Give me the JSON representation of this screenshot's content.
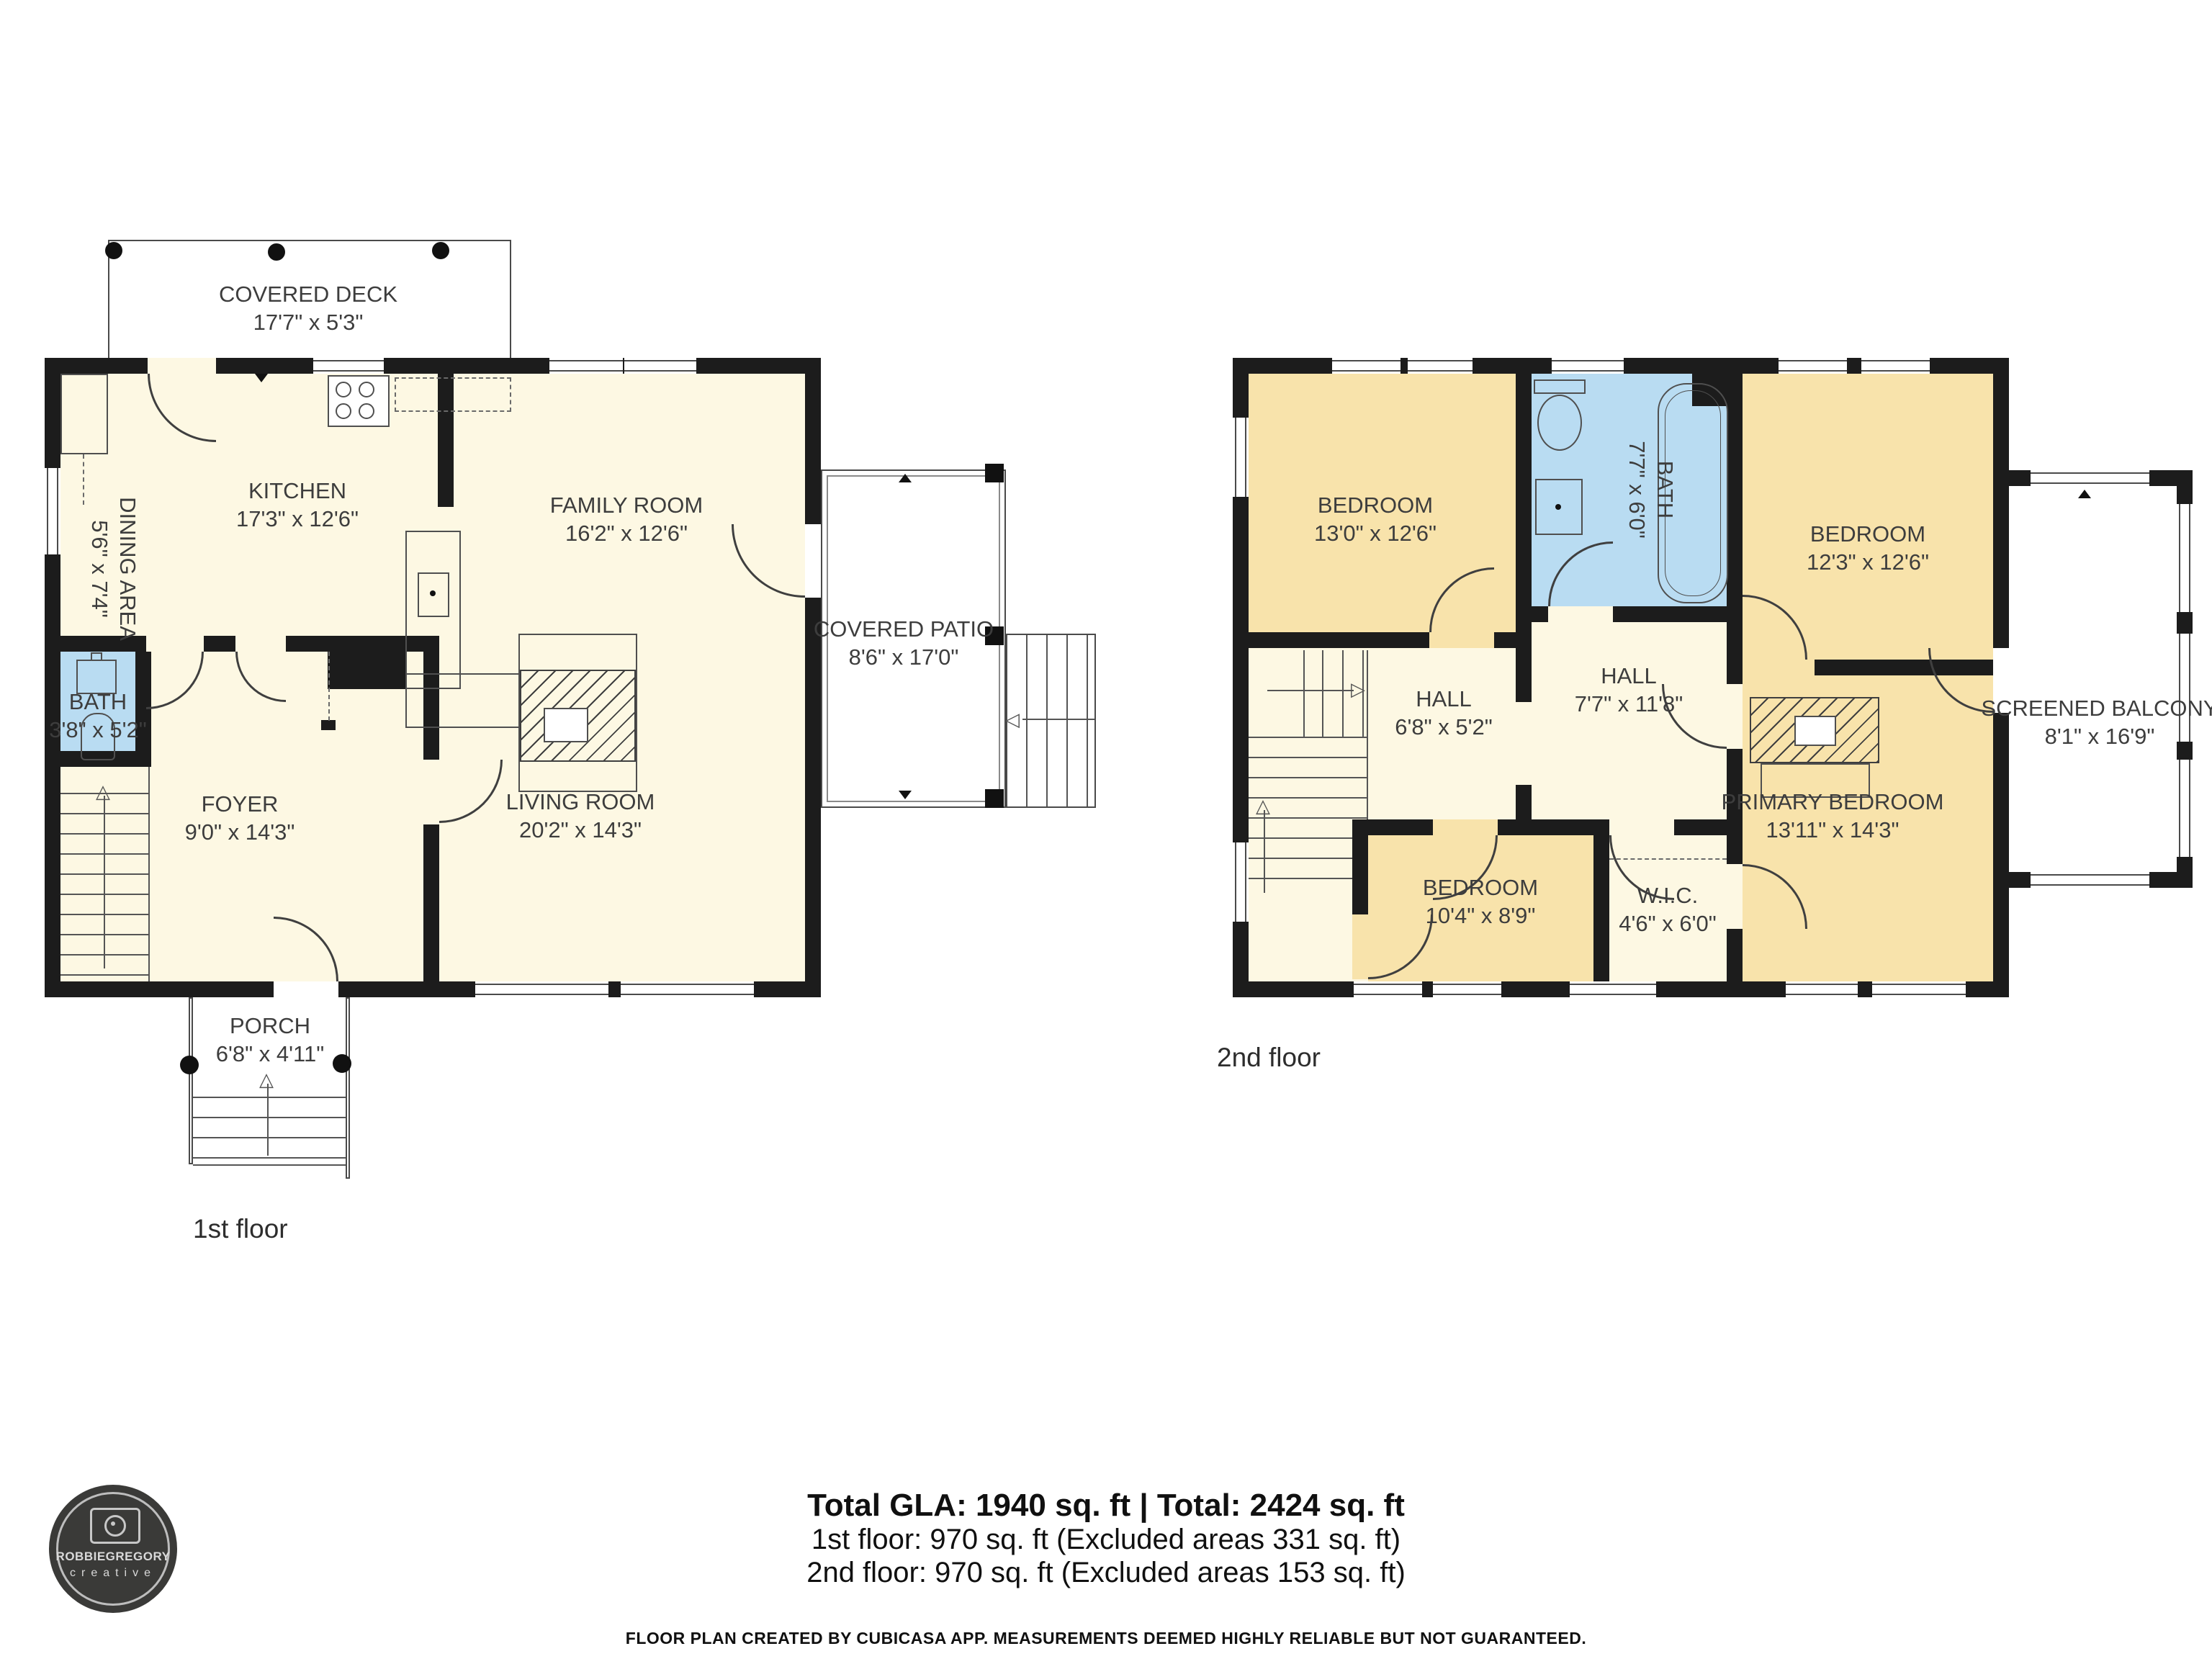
{
  "colors": {
    "wall": "#1c1c1c",
    "floor_cream": "#fdf8e3",
    "bedroom_tan": "#f8e3ab",
    "bath_blue": "#b9dcf2",
    "line_gray": "#4a4a4a",
    "text": "#3d3d3d"
  },
  "floor1": {
    "label": "1st floor",
    "covered_deck": {
      "name": "COVERED DECK",
      "dims": "17'7\" x 5'3\""
    },
    "kitchen": {
      "name": "KITCHEN",
      "dims": "17'3\" x 12'6\""
    },
    "dining_area": {
      "name": "DINING AREA",
      "dims": "5'6\" x 7'4\""
    },
    "family_room": {
      "name": "FAMILY ROOM",
      "dims": "16'2\" x 12'6\""
    },
    "bath": {
      "name": "BATH",
      "dims": "3'8\" x 5'2\""
    },
    "foyer": {
      "name": "FOYER",
      "dims": "9'0\" x 14'3\""
    },
    "living_room": {
      "name": "LIVING ROOM",
      "dims": "20'2\" x 14'3\""
    },
    "covered_patio": {
      "name": "COVERED PATIO",
      "dims": "8'6\" x 17'0\""
    },
    "porch": {
      "name": "PORCH",
      "dims": "6'8\" x 4'11\""
    }
  },
  "floor2": {
    "label": "2nd floor",
    "bedroom_1": {
      "name": "BEDROOM",
      "dims": "13'0\" x 12'6\""
    },
    "bath": {
      "name": "BATH",
      "dims": "7'7\" x 6'0\""
    },
    "bedroom_2": {
      "name": "BEDROOM",
      "dims": "12'3\" x 12'6\""
    },
    "hall_upper": {
      "name": "HALL",
      "dims": "7'7\" x 11'8\""
    },
    "hall_lower": {
      "name": "HALL",
      "dims": "6'8\" x 5'2\""
    },
    "bedroom_3": {
      "name": "BEDROOM",
      "dims": "10'4\" x 8'9\""
    },
    "wic": {
      "name": "W.I.C.",
      "dims": "4'6\" x 6'0\""
    },
    "primary_bedroom": {
      "name": "PRIMARY BEDROOM",
      "dims": "13'11\" x 14'3\""
    },
    "screened_balcony": {
      "name": "SCREENED BALCONY",
      "dims": "8'1\" x 16'9\""
    }
  },
  "summary": {
    "total": "Total GLA: 1940 sq. ft | Total: 2424 sq. ft",
    "floor1_line": "1st floor: 970 sq. ft (Excluded areas 331 sq. ft)",
    "floor2_line": "2nd floor: 970 sq. ft (Excluded areas 153 sq. ft)"
  },
  "footer": "FLOOR PLAN CREATED BY CUBICASA APP. MEASUREMENTS DEEMED HIGHLY RELIABLE BUT NOT GUARANTEED.",
  "logo": {
    "name": "ROBBIEGREGORY",
    "tagline": "creative"
  }
}
